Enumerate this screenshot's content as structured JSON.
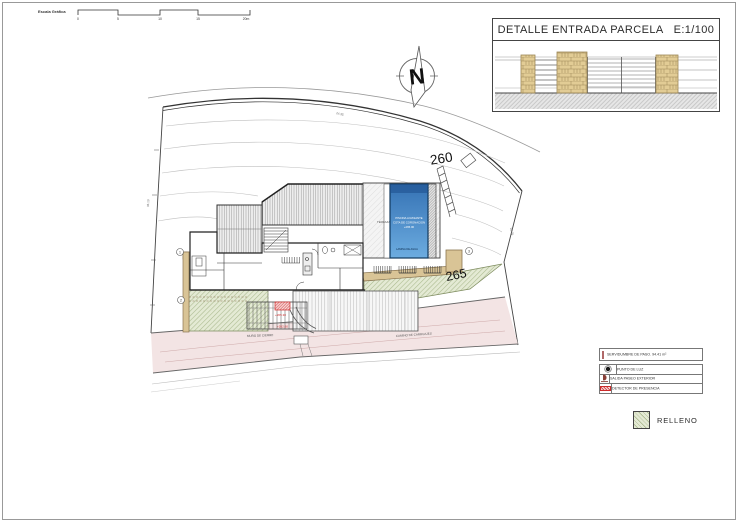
{
  "colors": {
    "pool_top": "#3572b4",
    "pool_bottom": "#6cace0",
    "pool_band": "#1d4f8c",
    "green": "#e4ead4",
    "green_hatch": "#a3b385",
    "tan": "#d9c496",
    "tan_dark": "#8a7550",
    "pink": "#f3e4e4",
    "pink_line": "#cfaaaa",
    "pink_swatch": "#efc6c6",
    "stone": "#e2cc95",
    "stone_line": "#9c8655",
    "red": "#cc2b2b"
  },
  "scale_bar": {
    "title": "Escala Gráfica",
    "ticks": [
      "0",
      "5",
      "10",
      "15",
      "20m"
    ]
  },
  "north": {
    "label": "N"
  },
  "detail_box": {
    "title": "DETALLE ENTRADA PARCELA",
    "scale": "E:1/100"
  },
  "site": {
    "contour_upper": "260",
    "contour_lower": "265",
    "pool_lines": [
      "PISCINA A RASANTE",
      "COTA DE CORONACION",
      "+265.00"
    ],
    "pool_caption": "LAMINA DE AGUA",
    "terrace_label": "TERRAZA",
    "wall_label": "MURO DE CIERRE",
    "path_label": "CAMINO DE CARRUAJES",
    "level_notes": [
      "+265.30",
      "+262.60"
    ],
    "dim_notes": [
      "24.35",
      "35.10",
      "28.76"
    ],
    "markers": [
      "1",
      "2",
      "3"
    ]
  },
  "legend": {
    "servidumbre": {
      "label": "SERVIDUMBRE DE PASO. 94.41 m²"
    },
    "rows": [
      {
        "icon": "light-point",
        "label": "PUNTO DE LUZ"
      },
      {
        "icon": "exterior-walk-exit",
        "label": "SALIDA PASEO EXTERIOR"
      },
      {
        "icon": "presence-detector",
        "label": "DETECTOR DE PRESENCIA"
      }
    ],
    "relleno": {
      "label": "RELLENO"
    }
  }
}
